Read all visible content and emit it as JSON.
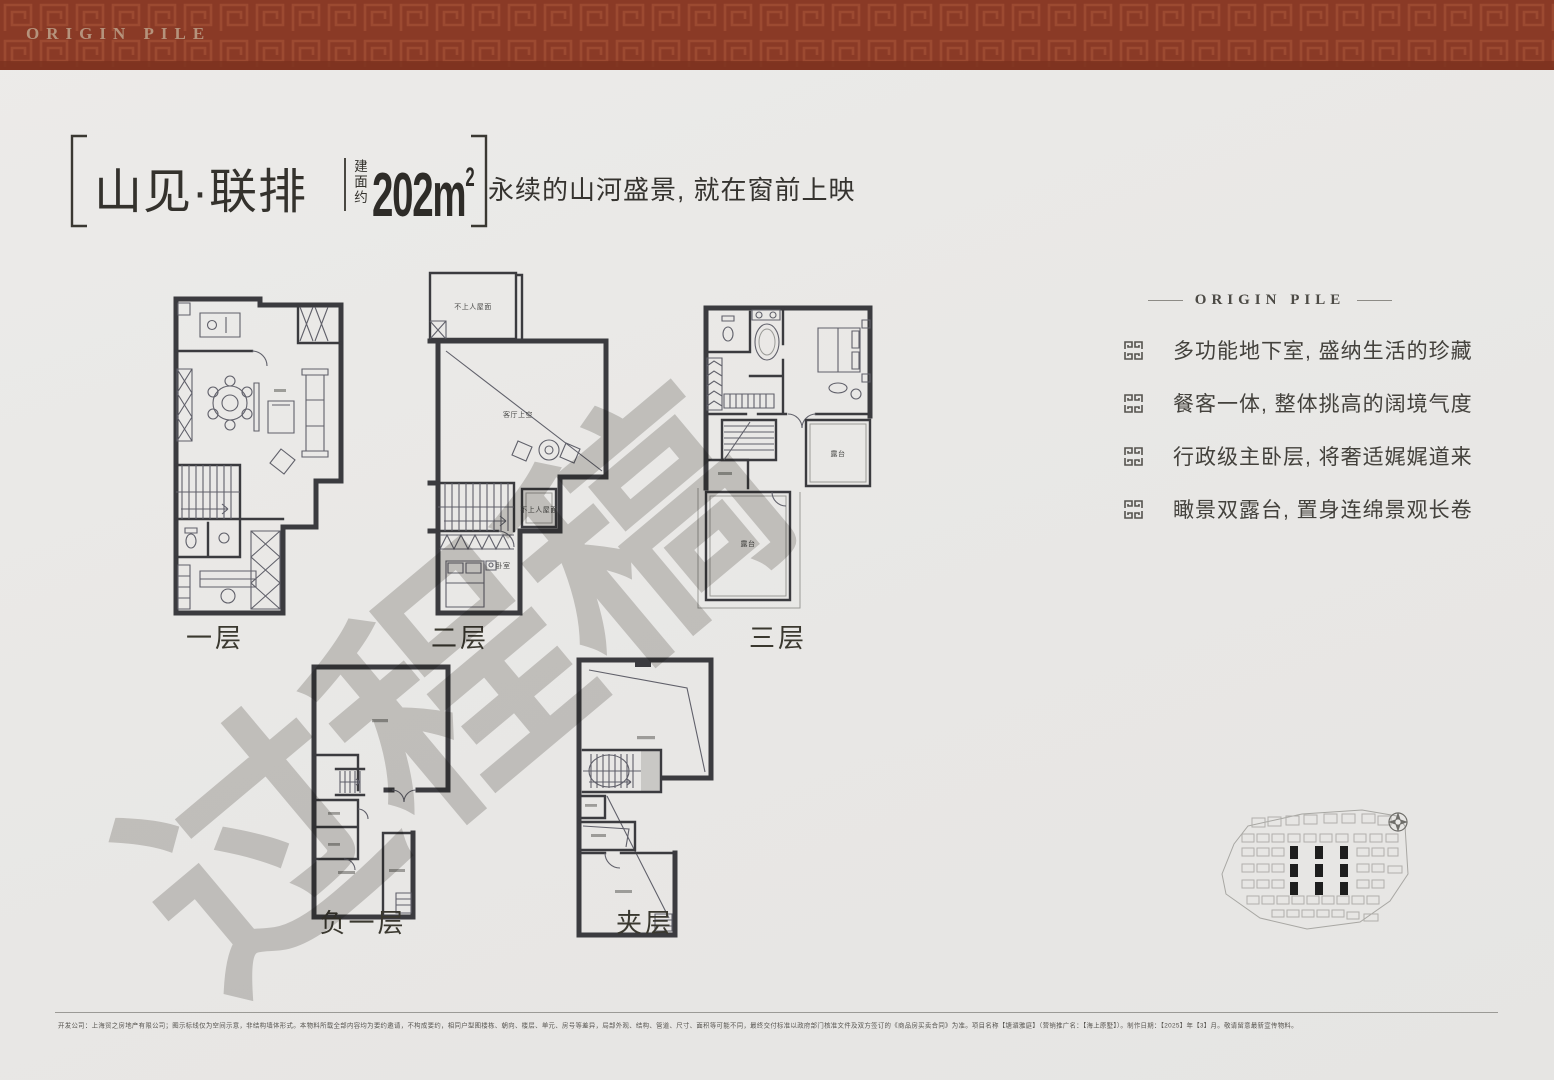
{
  "header": {
    "brand": "ORIGIN PILE",
    "band_color": "#8a3a26",
    "pattern_color": "#9c4a31"
  },
  "title": {
    "name": "山见·联排",
    "area_prefix": "建面约",
    "area_value": "202m",
    "area_sup": "2",
    "subtitle": "永续的山河盛景, 就在窗前上映"
  },
  "plans": [
    {
      "label": "一层"
    },
    {
      "label": "二层",
      "roof_label": "不上人屋面",
      "void_label": "客厅上空",
      "bedroom_label": "卧室",
      "roof2_label": "不上人屋面"
    },
    {
      "label": "三层",
      "terrace_label": "露台",
      "terrace2_label": "露台"
    },
    {
      "label": "负一层"
    },
    {
      "label": "夹层"
    }
  ],
  "highlights": {
    "heading": "ORIGIN PILE",
    "items": [
      "多功能地下室, 盛纳生活的珍藏",
      "餐客一体, 整体挑高的阔境气度",
      "行政级主卧层, 将奢适娓娓道来",
      "瞰景双露台, 置身连绵景观长卷"
    ]
  },
  "watermark": "过程稿",
  "footer": {
    "disclaimer": "开发公司：上海贸之房地产有限公司；图示标线仅为空间示意，非结构墙体形式。本物料所载全部内容均为要约邀请，不构成要约，相同户型图楼栋、朝向、楼层、单元、房号等差异，局部外观、结构、管道、尺寸、面积等可能不同，最终交付标准以政府部门核准文件及双方签订的《商品房买卖合同》为准。项目名称【塘湄雅庭】（营销推广名：【海上原墅】）。制作日期：【2025】年【3】月。敬请留意最新宣传物料。"
  }
}
